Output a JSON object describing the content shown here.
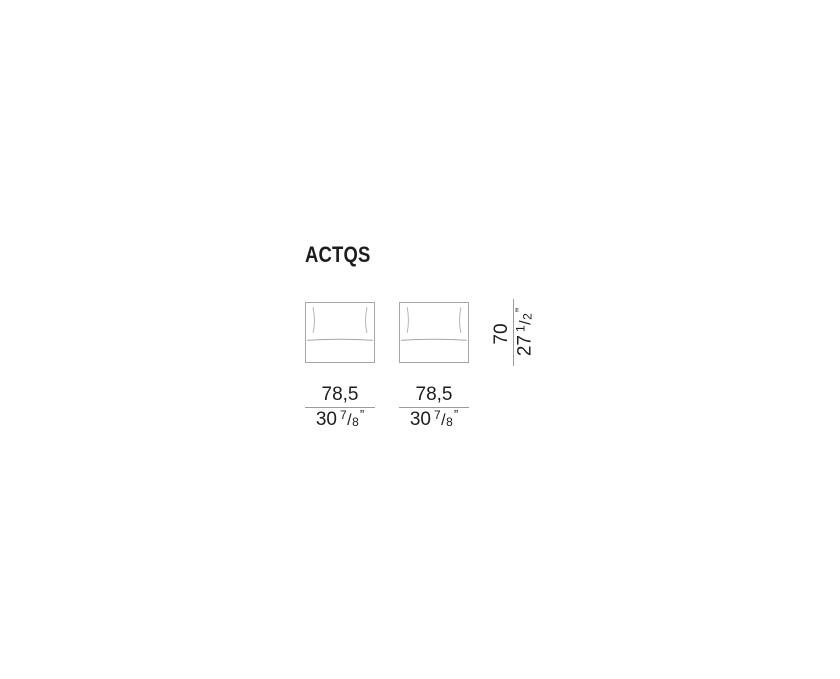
{
  "sheet": {
    "title": "ACTQS",
    "width_dims": [
      {
        "metric": "78,5",
        "imp_whole": "30",
        "imp_num": "7",
        "imp_slash": "/",
        "imp_den": "8",
        "imp_quote": "”"
      },
      {
        "metric": "78,5",
        "imp_whole": "30",
        "imp_num": "7",
        "imp_slash": "/",
        "imp_den": "8",
        "imp_quote": "”"
      }
    ],
    "height_dim": {
      "metric": "70",
      "imp_whole": "27",
      "imp_num": "1",
      "imp_slash": "/",
      "imp_den": "2",
      "imp_quote": "”"
    },
    "colors": {
      "ink": "#1d1d1b",
      "line": "#9b9b9b",
      "drawing_outline": "#a6a6a6",
      "drawing_detail": "#b7b7b7"
    }
  }
}
